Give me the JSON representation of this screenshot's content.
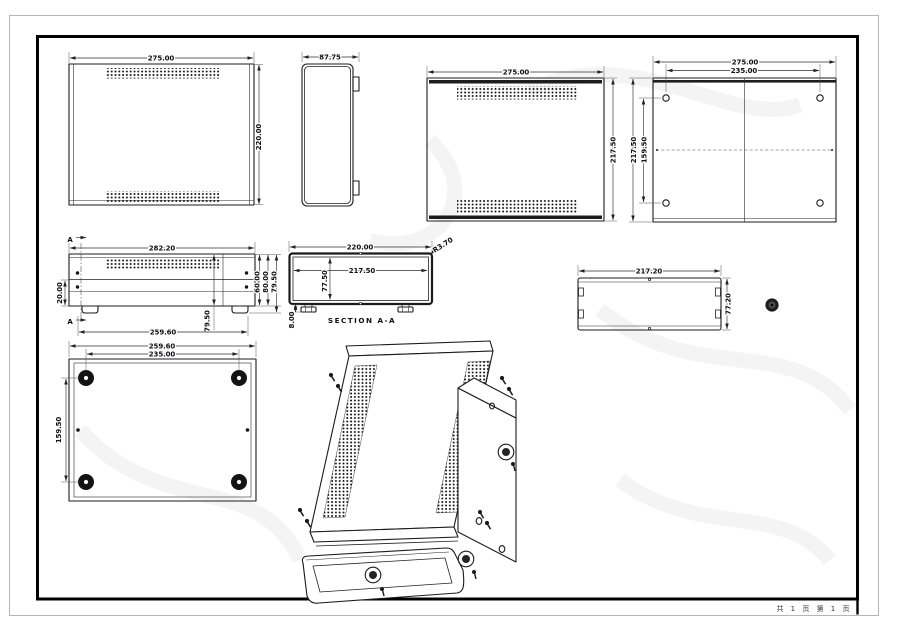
{
  "sheet": {
    "page_note": "共 1 页  第 1 页"
  },
  "colors": {
    "line": "#1b1b1b",
    "frame": "#000000",
    "outer_border": "#b6b6b6",
    "paper": "#ffffff"
  },
  "views": {
    "panel_front": {
      "width": "275.00",
      "height": "220.00"
    },
    "panel_side": {
      "width": "87.75"
    },
    "cover_top": {
      "width": "275.00",
      "height": "217.50"
    },
    "base_plate": {
      "width": "275.00",
      "hole_spacing_width": "235.00",
      "height": "217.50",
      "hole_spacing_height": "159.50"
    },
    "chassis_front": {
      "width": "282.20",
      "lower_height": "20.00",
      "height_a": "60.00",
      "height_b": "80.00",
      "height_c": "79.50",
      "body_height": "79.50",
      "base_width": "259.60",
      "section_mark": "A"
    },
    "section_aa": {
      "title": "SECTION A-A",
      "outer_width": "220.00",
      "inner_width": "217.50",
      "inner_height": "77.50",
      "foot_height": "8.00",
      "corner_radius": "R3.70"
    },
    "chassis_rear": {
      "width": "217.20",
      "height": "77.20"
    },
    "chassis_bottom": {
      "width": "259.60",
      "foot_spacing_width": "235.00",
      "foot_spacing_height": "159.50"
    }
  }
}
